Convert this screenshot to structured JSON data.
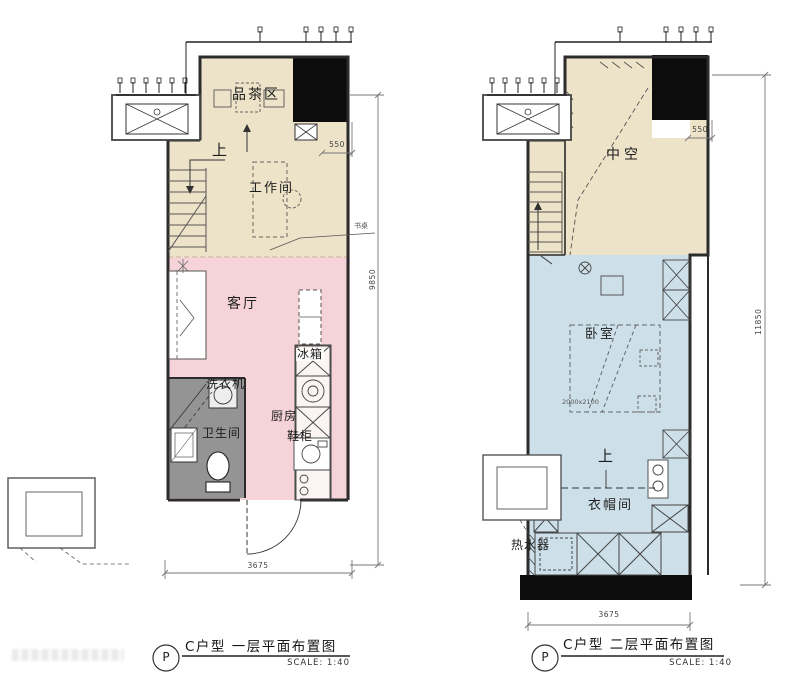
{
  "plan_first": {
    "labels": {
      "tea_area": "品茶区",
      "up": "上",
      "workroom": "工作间",
      "living_room": "客厅",
      "fridge": "冰箱",
      "washing_machine": "洗衣机",
      "bathroom": "卫生间",
      "kitchen": "厨房",
      "shoe_cabinet": "鞋柜",
      "desk_note": "书桌"
    },
    "dimensions": {
      "shaft_width": "550",
      "height": "9850",
      "width": "3675"
    },
    "caption": {
      "bubble": "P",
      "title": "C户型  一层平面布置图",
      "scale": "SCALE:  1:40"
    }
  },
  "plan_second": {
    "labels": {
      "void": "中空",
      "bedroom": "卧室",
      "bed_size": "2000x2100",
      "up": "上",
      "cloakroom": "衣帽间",
      "water_heater": "热水器"
    },
    "dimensions": {
      "shaft_width": "550",
      "height": "11850",
      "width": "3675"
    },
    "caption": {
      "bubble": "P",
      "title": "C户型  二层平面布置图",
      "scale": "SCALE:  1:40"
    }
  },
  "colors": {
    "beige": "#EDE3C8",
    "pink": "#F5D3D8",
    "blue": "#CDE0EA",
    "bath_gray": "#949494",
    "shaft_black": "#0c0c0c"
  }
}
